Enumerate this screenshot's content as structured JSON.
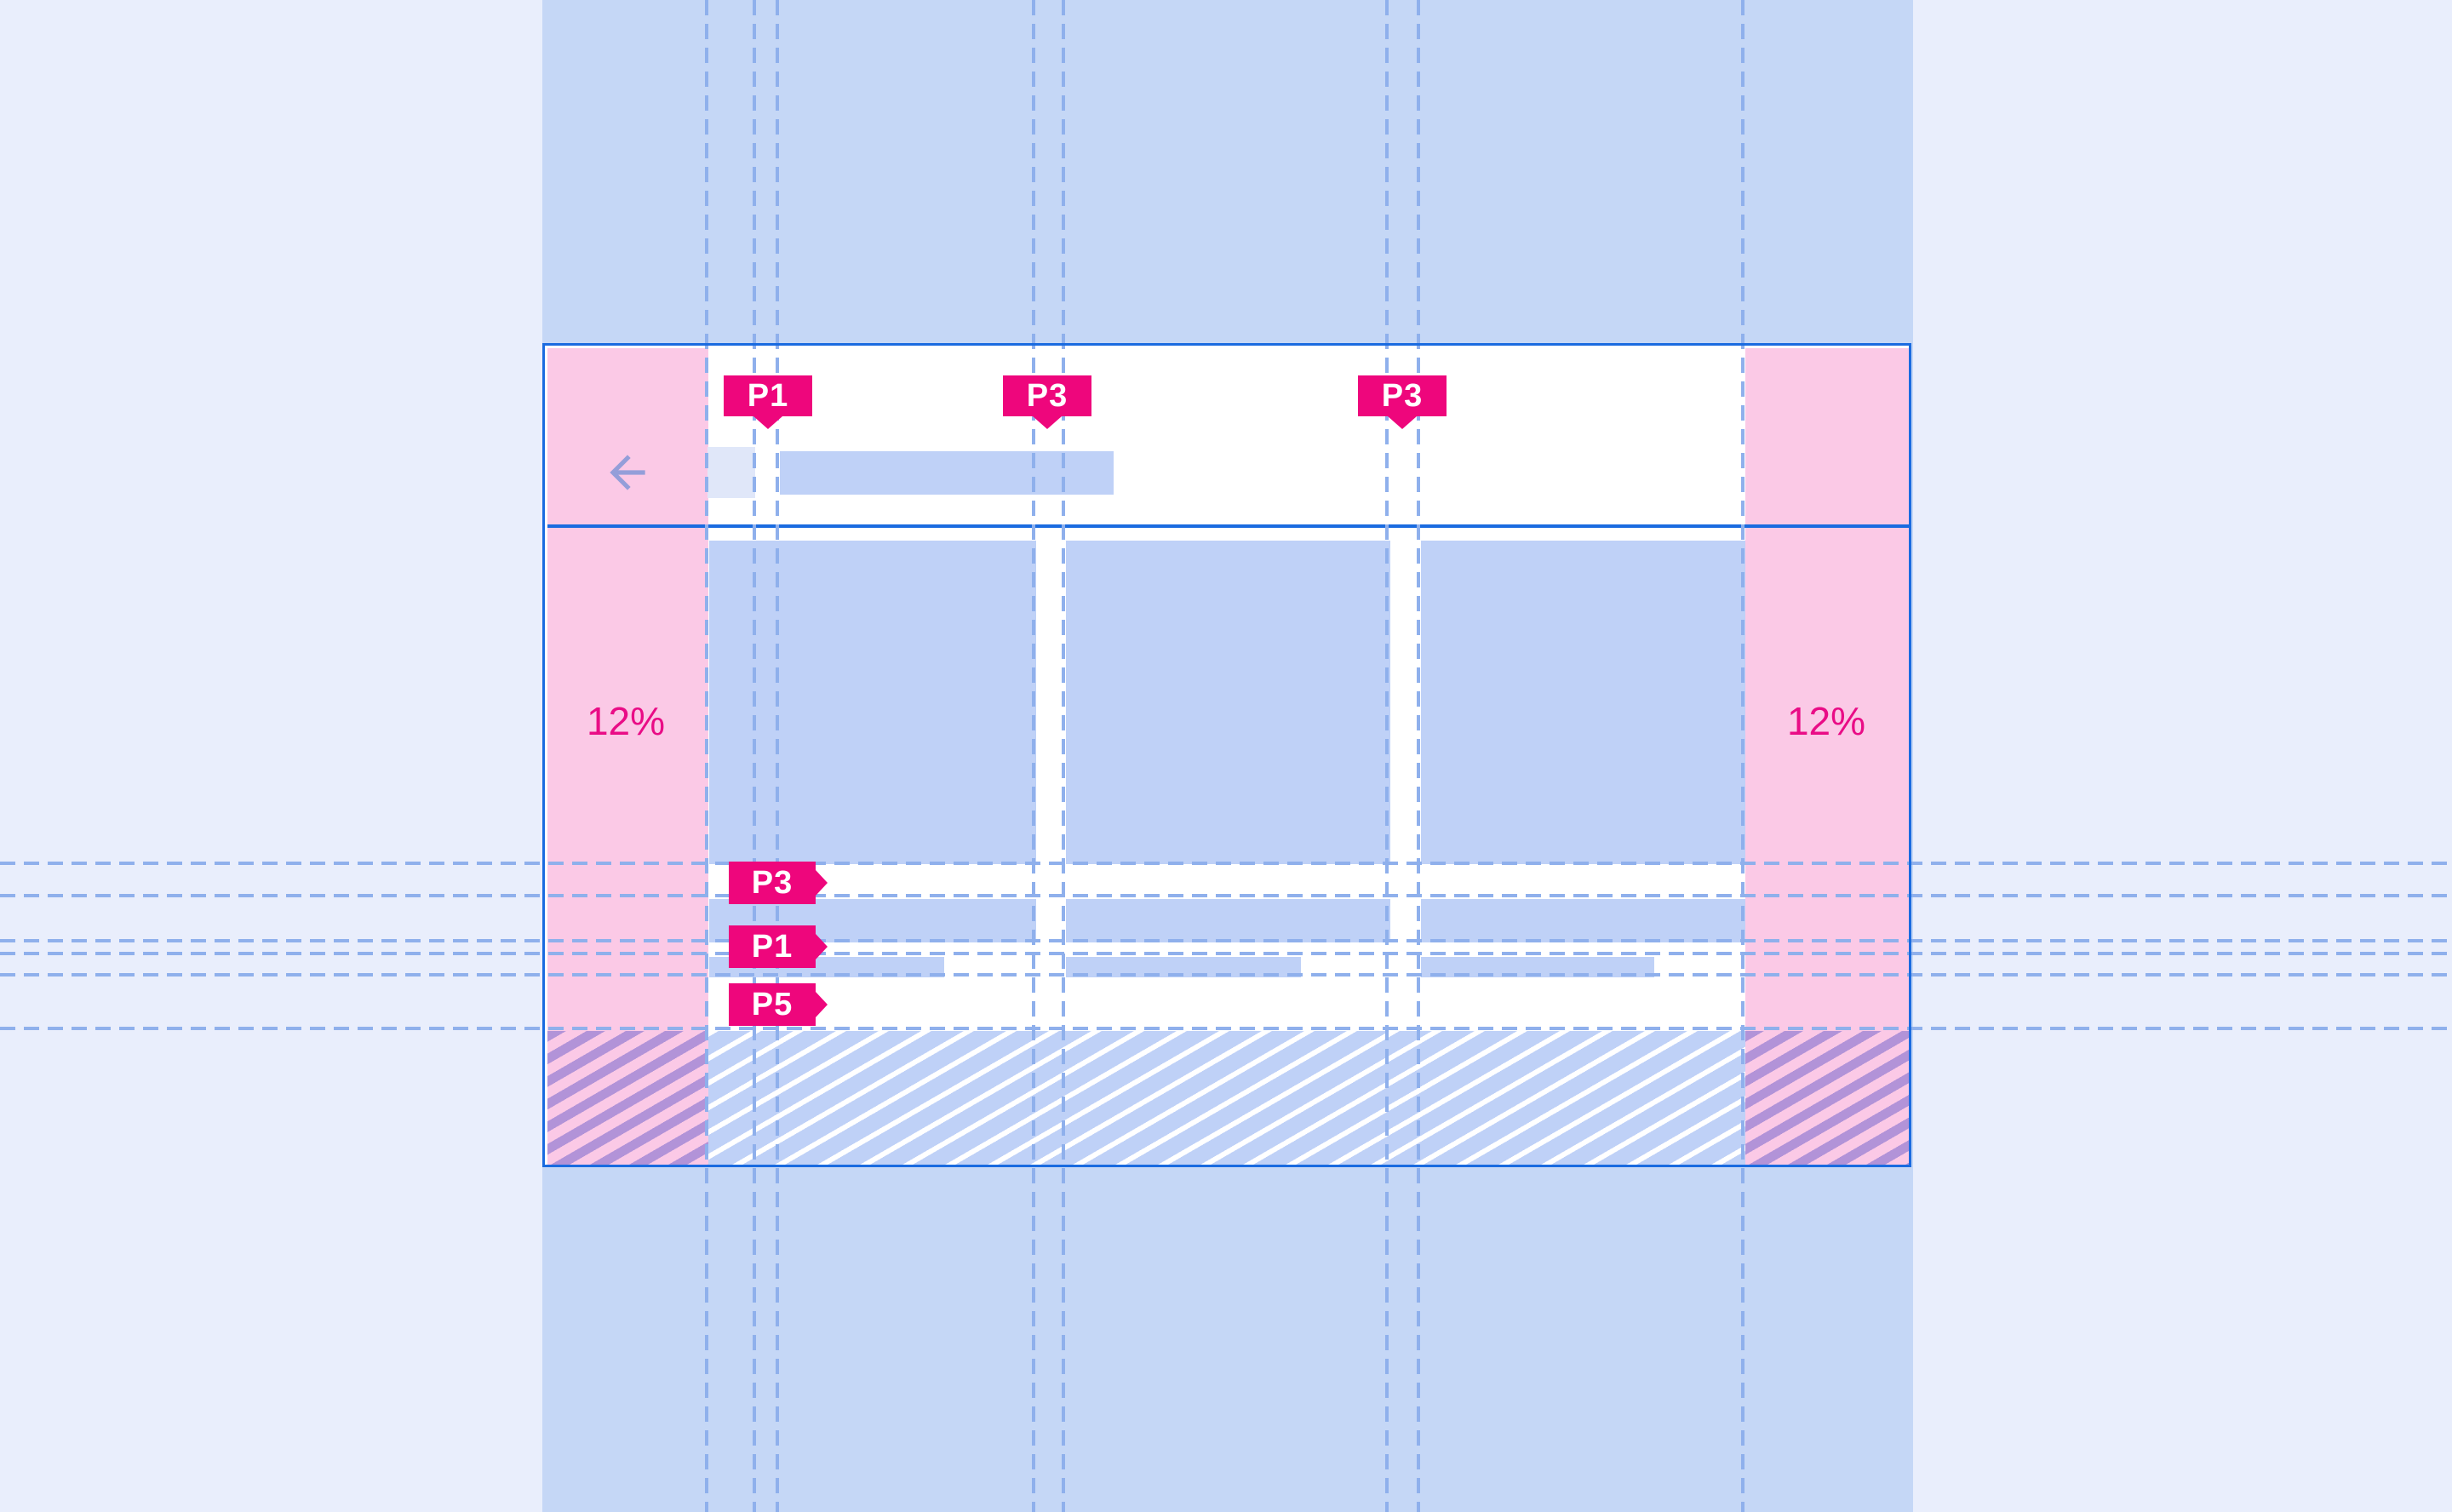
{
  "annotations": {
    "top_padding_chips": [
      {
        "label": "P1"
      },
      {
        "label": "P3"
      },
      {
        "label": "P3"
      }
    ],
    "left_padding_chips": [
      {
        "label": "P3"
      },
      {
        "label": "P1"
      },
      {
        "label": "P5"
      }
    ],
    "margin_percent_labels": {
      "left": "12%",
      "right": "12%"
    }
  },
  "mockup": {
    "back_icon": "arrow-left",
    "placeholders": [
      "app-bar-title",
      "card",
      "list-row",
      "system-bar-hatch"
    ]
  },
  "colors": {
    "page_bg": "#e9eefc",
    "band_blue": "#c5d7f6",
    "frame_blue": "#1a6be0",
    "margin_pink": "#fbc9e6",
    "card_blue": "#bfd1f7",
    "icon_square_blue": "#e0e7f9",
    "guide_blue": "#8fb0ec",
    "chip_pink": "#ee067c",
    "percent_pink": "#e90c86",
    "arrow_purple": "#949ed9",
    "hatch_purple": "#b293d8",
    "hatch_white": "#ffffff"
  }
}
